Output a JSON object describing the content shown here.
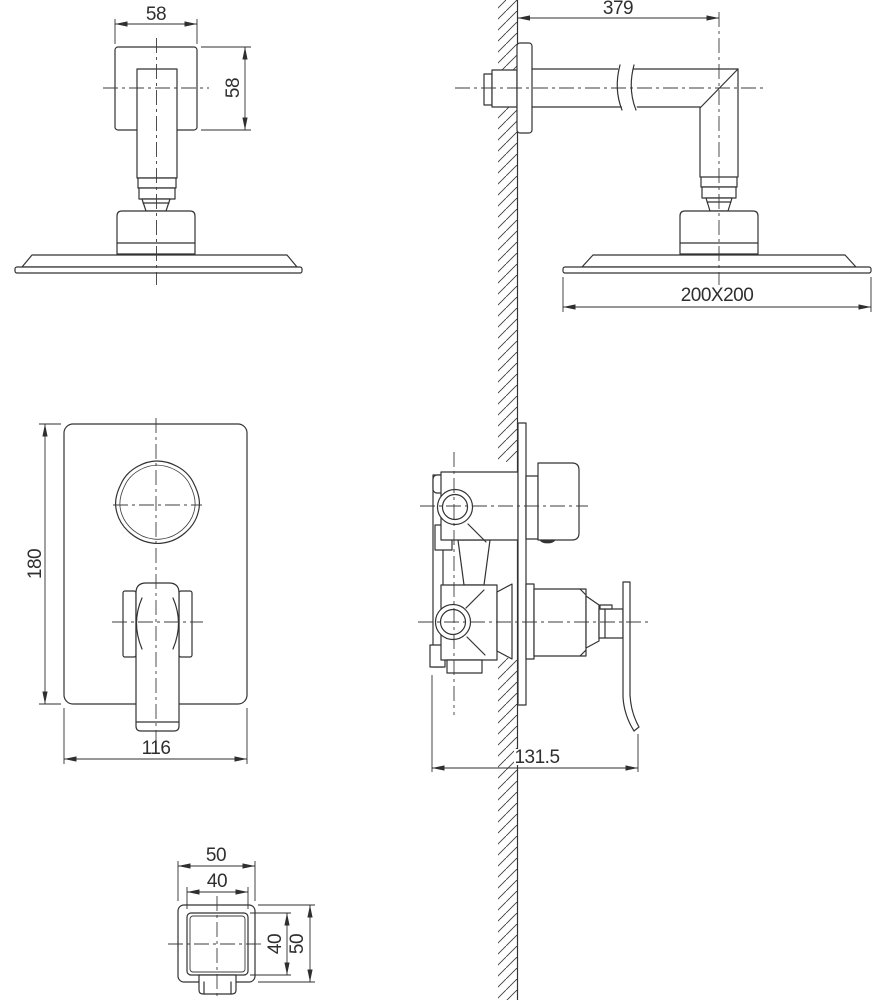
{
  "drawing": {
    "type": "technical-dimension-drawing",
    "subject": "concealed-shower-set",
    "colors": {
      "background": "#ffffff",
      "line": "#333333",
      "dim_text": "#2f2f2f"
    },
    "dims": {
      "head_front_width": "58",
      "head_front_height": "58",
      "arm_length": "379",
      "head_size": "200X200",
      "plate_height": "180",
      "plate_width": "116",
      "valve_depth": "131.5",
      "spout_outer_width": "50",
      "spout_inner_width": "40",
      "spout_inner_height": "40",
      "spout_outer_height": "50"
    }
  }
}
